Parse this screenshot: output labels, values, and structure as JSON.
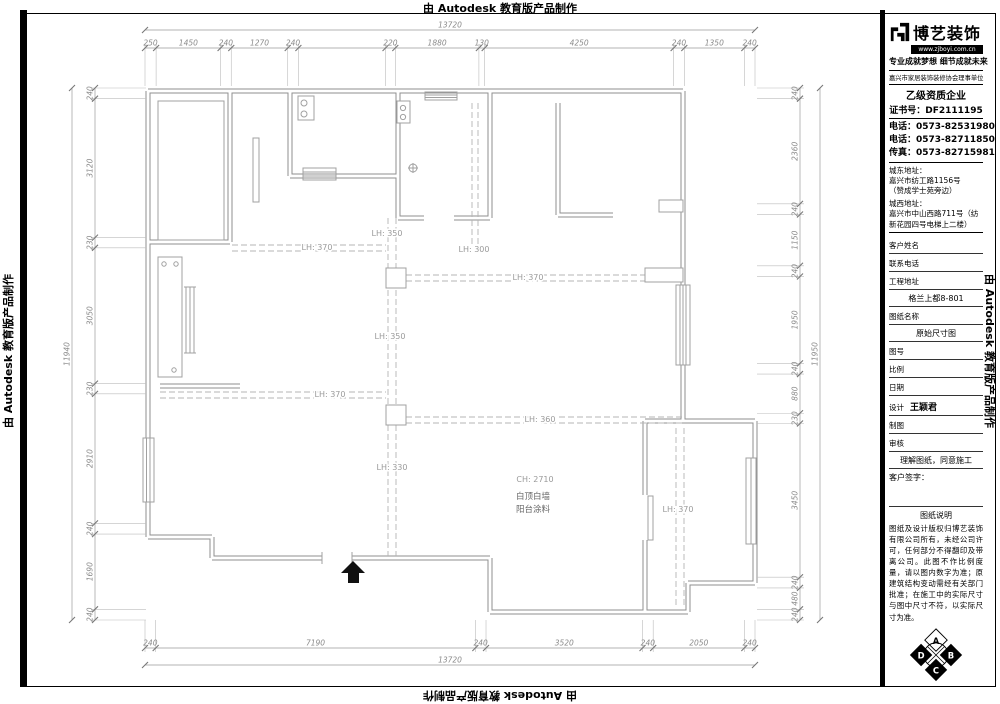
{
  "edge_text": "由 Autodesk 教育版产品制作",
  "title_block": {
    "logo_text": "博艺装饰",
    "logo_url": "www.zjboyi.com.cn",
    "slogan": "专业成就梦想 细节成就未来",
    "membership": "嘉兴市家居装饰装修协会理事单位",
    "grade": "乙级资质企业",
    "cert_no": "证书号：DF2111195",
    "phone1": "电话：0573-82531980",
    "phone2": "电话：0573-82711850",
    "fax": "传真：0573-82715981",
    "addr_east_label": "城东地址：",
    "addr_east": "嘉兴市纺工路1156号",
    "addr_east_note": "（赞成学士苑旁边）",
    "addr_west_label": "城西地址：",
    "addr_west": "嘉兴市中山西路711号（纺新花园四号电梯上二楼）",
    "fields": [
      {
        "label": "客户姓名",
        "value": ""
      },
      {
        "label": "联系电话",
        "value": ""
      },
      {
        "label": "工程地址",
        "value": "格兰上都8-801"
      },
      {
        "label": "图纸名称",
        "value": "原始尺寸图"
      },
      {
        "label": "图号",
        "value": ""
      },
      {
        "label": "比例",
        "value": ""
      },
      {
        "label": "日期",
        "value": ""
      },
      {
        "label": "设计",
        "value": "王颖君",
        "inline": true
      },
      {
        "label": "制图",
        "value": ""
      },
      {
        "label": "审核",
        "value": "理解图纸，同意施工"
      }
    ],
    "signature_label": "客户签字：",
    "notes_title": "图纸说明",
    "notes": "图纸及设计版权归博艺装饰有限公司所有，未经公司许可，任何部分不得翻印及带离公司。此图不作比例度量，请以图内数字为准；原建筑结构变动需经有关部门批准；在施工中的实际尺寸与图中尺寸不符，以实际尺寸为准。",
    "compass": [
      "A",
      "B",
      "C",
      "D"
    ]
  },
  "plan": {
    "dims": {
      "top": {
        "overall": "13720",
        "segments": [
          {
            "len": 250,
            "label": "250"
          },
          {
            "len": 1450,
            "label": "1450"
          },
          {
            "len": 240,
            "label": "240"
          },
          {
            "len": 1270,
            "label": "1270"
          },
          {
            "len": 240,
            "label": "240"
          },
          {
            "len": 1960,
            "label": ""
          },
          {
            "len": 220,
            "label": "220"
          },
          {
            "len": 1880,
            "label": "1880"
          },
          {
            "len": 130,
            "label": "130"
          },
          {
            "len": 4250,
            "label": "4250"
          },
          {
            "len": 240,
            "label": "240"
          },
          {
            "len": 1350,
            "label": "1350"
          },
          {
            "len": 240,
            "label": "240"
          }
        ]
      },
      "bottom": {
        "overall": "13720",
        "segments": [
          {
            "len": 240,
            "label": "240"
          },
          {
            "len": 7190,
            "label": "7190"
          },
          {
            "len": 240,
            "label": "240"
          },
          {
            "len": 3520,
            "label": "3520"
          },
          {
            "len": 240,
            "label": "240"
          },
          {
            "len": 2050,
            "label": "2050"
          },
          {
            "len": 240,
            "label": "240"
          }
        ]
      },
      "left": {
        "overall": "11940",
        "segments": [
          {
            "len": 240,
            "label": "240"
          },
          {
            "len": 3120,
            "label": "3120"
          },
          {
            "len": 230,
            "label": "230"
          },
          {
            "len": 3050,
            "label": "3050"
          },
          {
            "len": 230,
            "label": "230"
          },
          {
            "len": 2910,
            "label": "2910"
          },
          {
            "len": 240,
            "label": "240"
          },
          {
            "len": 1690,
            "label": "1690"
          },
          {
            "len": 240,
            "label": "240"
          }
        ]
      },
      "right": {
        "overall": "11950",
        "segments": [
          {
            "len": 240,
            "label": "240"
          },
          {
            "len": 2360,
            "label": "2360"
          },
          {
            "len": 240,
            "label": "240"
          },
          {
            "len": 1150,
            "label": "1150"
          },
          {
            "len": 240,
            "label": "240"
          },
          {
            "len": 1950,
            "label": "1950"
          },
          {
            "len": 240,
            "label": "240"
          },
          {
            "len": 880,
            "label": "880"
          },
          {
            "len": 230,
            "label": "230"
          },
          {
            "len": 3450,
            "label": "3450"
          },
          {
            "len": 240,
            "label": "240"
          },
          {
            "len": 480,
            "label": "480"
          },
          {
            "len": 240,
            "label": "240"
          }
        ]
      }
    },
    "beam_labels": [
      {
        "text": "LH: 350",
        "x": 387,
        "y": 236
      },
      {
        "text": "LH: 300",
        "x": 474,
        "y": 252
      },
      {
        "text": "LH: 370",
        "x": 317,
        "y": 250
      },
      {
        "text": "LH: 370",
        "x": 528,
        "y": 280
      },
      {
        "text": "LH: 350",
        "x": 390,
        "y": 339
      },
      {
        "text": "LH: 370",
        "x": 330,
        "y": 397
      },
      {
        "text": "LH: 360",
        "x": 540,
        "y": 422
      },
      {
        "text": "LH: 330",
        "x": 392,
        "y": 470
      },
      {
        "text": "LH: 370",
        "x": 678,
        "y": 512
      }
    ],
    "room_notes": [
      {
        "text": "CH: 2710",
        "x": 535,
        "y": 482,
        "muted": true
      },
      {
        "text": "白顶白墙",
        "x": 533,
        "y": 499
      },
      {
        "text": "阳台涂料",
        "x": 533,
        "y": 512
      }
    ]
  }
}
